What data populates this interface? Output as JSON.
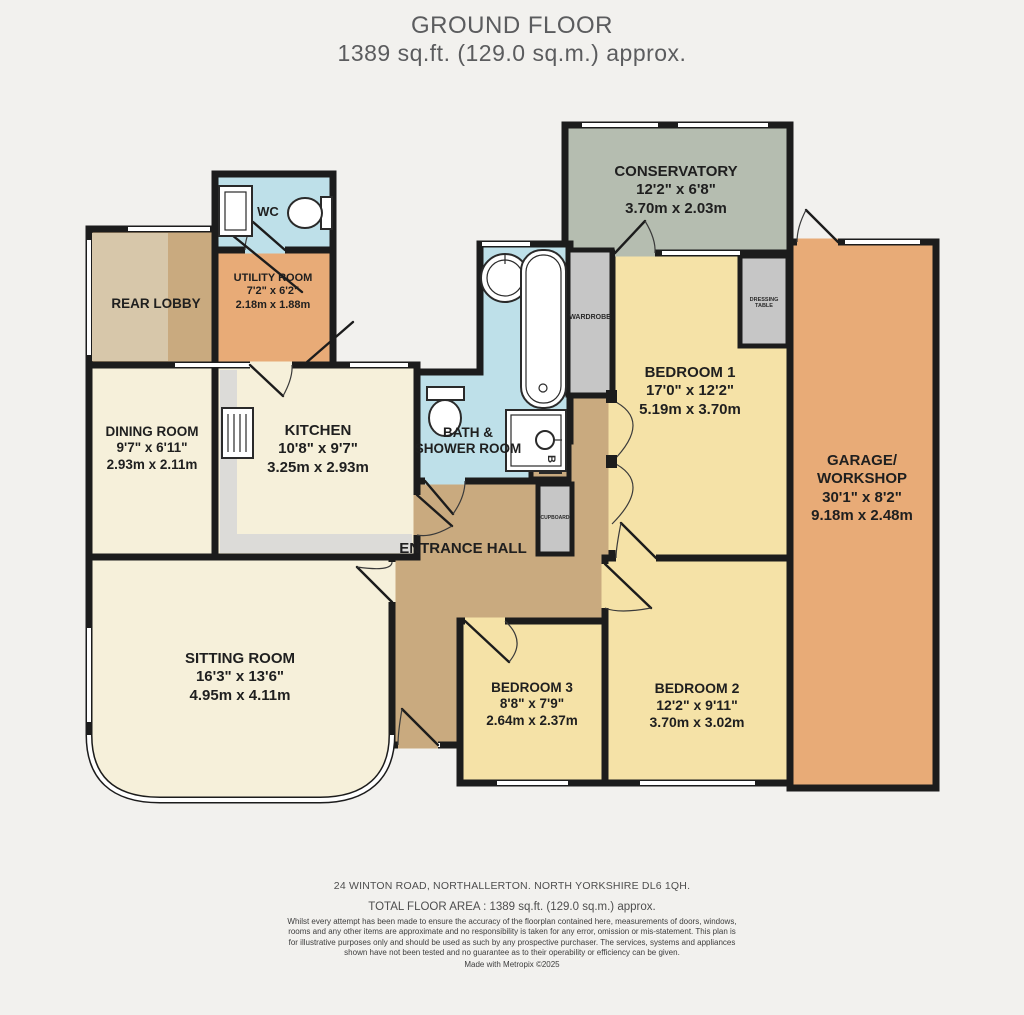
{
  "title": {
    "line1": "GROUND FLOOR",
    "line2": "1389 sq.ft. (129.0 sq.m.) approx."
  },
  "rooms": {
    "conservatory": {
      "name": "CONSERVATORY",
      "imperial": "12'2\"  x 6'8\"",
      "metric": "3.70m  x 2.03m"
    },
    "garage": {
      "name1": "GARAGE/",
      "name2": "WORKSHOP",
      "imperial": "30'1\"  x 8'2\"",
      "metric": "9.18m  x 2.48m"
    },
    "utility": {
      "name": "UTILITY ROOM",
      "imperial": "7'2\"  x 6'2\"",
      "metric": "2.18m  x 1.88m"
    },
    "rear_lobby": {
      "name": "REAR LOBBY"
    },
    "dining": {
      "name": "DINING ROOM",
      "imperial": "9'7\"  x 6'11\"",
      "metric": "2.93m  x 2.11m"
    },
    "kitchen": {
      "name": "KITCHEN",
      "imperial": "10'8\"  x 9'7\"",
      "metric": "3.25m  x 2.93m"
    },
    "bath": {
      "name1": "BATH &",
      "name2": "SHOWER ROOM"
    },
    "entrance_hall": {
      "name": "ENTRANCE HALL"
    },
    "sitting": {
      "name": "SITTING ROOM",
      "imperial": "16'3\"  x 13'6\"",
      "metric": "4.95m  x 4.11m"
    },
    "bedroom1": {
      "name": "BEDROOM 1",
      "imperial": "17'0\"  x 12'2\"",
      "metric": "5.19m  x 3.70m"
    },
    "bedroom2": {
      "name": "BEDROOM 2",
      "imperial": "12'2\"  x 9'11\"",
      "metric": "3.70m  x 3.02m"
    },
    "bedroom3": {
      "name": "BEDROOM 3",
      "imperial": "8'8\"  x 7'9\"",
      "metric": "2.64m  x 2.37m"
    }
  },
  "fixtures": {
    "wc": "WC",
    "wardrobe": "WARDROBE",
    "dressing_table": "DRESSING TABLE",
    "cupboard": "CUPBOARD",
    "boiler": "B"
  },
  "footer": {
    "address": "24 WINTON ROAD, NORTHALLERTON.  NORTH YORKSHIRE DL6 1QH.",
    "total_area": "TOTAL FLOOR AREA : 1389 sq.ft. (129.0 sq.m.) approx.",
    "disclaimer": "Whilst every attempt has been made to ensure the accuracy of the floorplan contained here, measurements of doors, windows, rooms and any other items are approximate and no responsibility is taken for any error, omission or mis-statement. This plan is for illustrative purposes only and should be used as such by any prospective purchaser. The services, systems and appliances shown have not been tested and no guarantee as to their operability or efficiency can be given.",
    "made_with": "Made with Metropix ©2025"
  },
  "colors": {
    "bg": "#f2f1ee",
    "wall": "#1c1c1c",
    "green": "#b5bdb0",
    "yellow": "#f5e2a7",
    "orange": "#e8ab77",
    "tan": "#c9aa7f",
    "tanlight": "#d7c7aa",
    "cream": "#f6f0da",
    "blue": "#bee0e9",
    "graybox": "#c6c6c6",
    "counter": "#dcdbd8",
    "title": "#5b5c5e",
    "footer": "#4e4e4e"
  }
}
